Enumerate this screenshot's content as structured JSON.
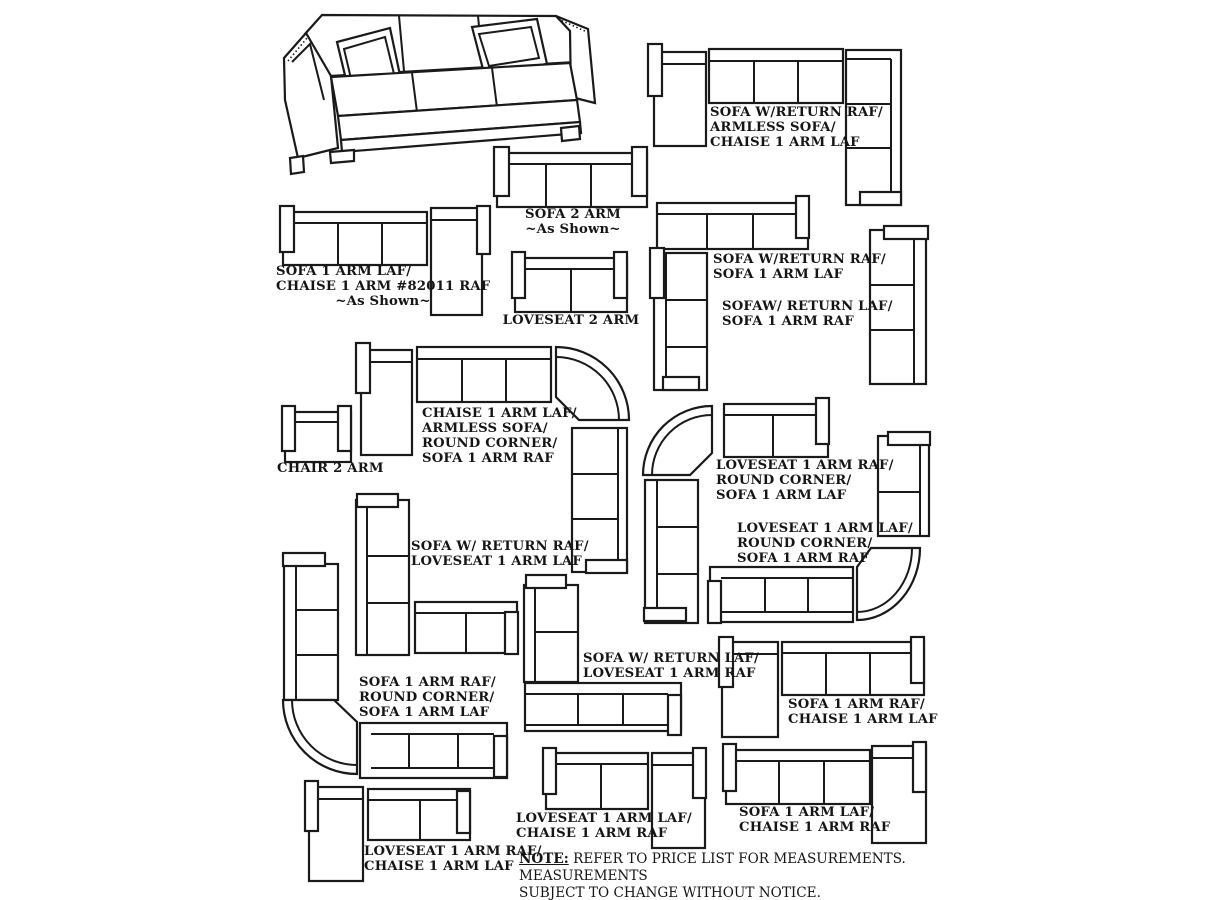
{
  "colors": {
    "ink": "#1a1a1a",
    "background": "#ffffff"
  },
  "labels": [
    {
      "lines": [
        "SOFA W/RETURN RAF/",
        "ARMLESS SOFA/",
        "CHAISE 1 ARM LAF"
      ]
    },
    {
      "lines": [
        "SOFA 2 ARM",
        "~As Shown~"
      ]
    },
    {
      "lines": [
        "SOFA 1 ARM LAF/",
        "CHAISE 1 ARM #82011 RAF",
        "~As Shown~"
      ]
    },
    {
      "lines": [
        "LOVESEAT 2 ARM"
      ]
    },
    {
      "lines": [
        "SOFA W/RETURN RAF/",
        "SOFA 1 ARM LAF"
      ]
    },
    {
      "lines": [
        "SOFAW/ RETURN LAF/",
        "SOFA 1 ARM RAF"
      ]
    },
    {
      "lines": [
        "CHAISE 1 ARM LAF/",
        "ARMLESS SOFA/",
        "ROUND CORNER/",
        "SOFA 1 ARM RAF"
      ]
    },
    {
      "lines": [
        "CHAIR 2 ARM"
      ]
    },
    {
      "lines": [
        "LOVESEAT 1 ARM RAF/",
        "ROUND CORNER/",
        "SOFA 1 ARM LAF"
      ]
    },
    {
      "lines": [
        "LOVESEAT 1 ARM LAF/",
        "ROUND CORNER/",
        "SOFA 1 ARM RAF"
      ]
    },
    {
      "lines": [
        "SOFA W/ RETURN RAF/",
        "LOVESEAT 1 ARM LAF"
      ]
    },
    {
      "lines": [
        "SOFA W/ RETURN LAF/",
        "LOVESEAT 1 ARM RAF"
      ]
    },
    {
      "lines": [
        "SOFA 1 ARM RAF/",
        "ROUND CORNER/",
        "SOFA 1 ARM LAF"
      ]
    },
    {
      "lines": [
        "SOFA 1 ARM RAF/",
        "CHAISE 1 ARM LAF"
      ]
    },
    {
      "lines": [
        "SOFA 1 ARM LAF/",
        "CHAISE 1 ARM RAF"
      ]
    },
    {
      "lines": [
        "LOVESEAT 1 ARM LAF/",
        "CHAISE 1 ARM RAF"
      ]
    },
    {
      "lines": [
        "LOVESEAT 1 ARM RAF/",
        "CHAISE 1 ARM LAF"
      ]
    }
  ],
  "note": {
    "label": "NOTE:",
    "line1": "REFER TO PRICE LIST FOR MEASUREMENTS. MEASUREMENTS",
    "line2": "SUBJECT TO CHANGE WITHOUT NOTICE."
  }
}
